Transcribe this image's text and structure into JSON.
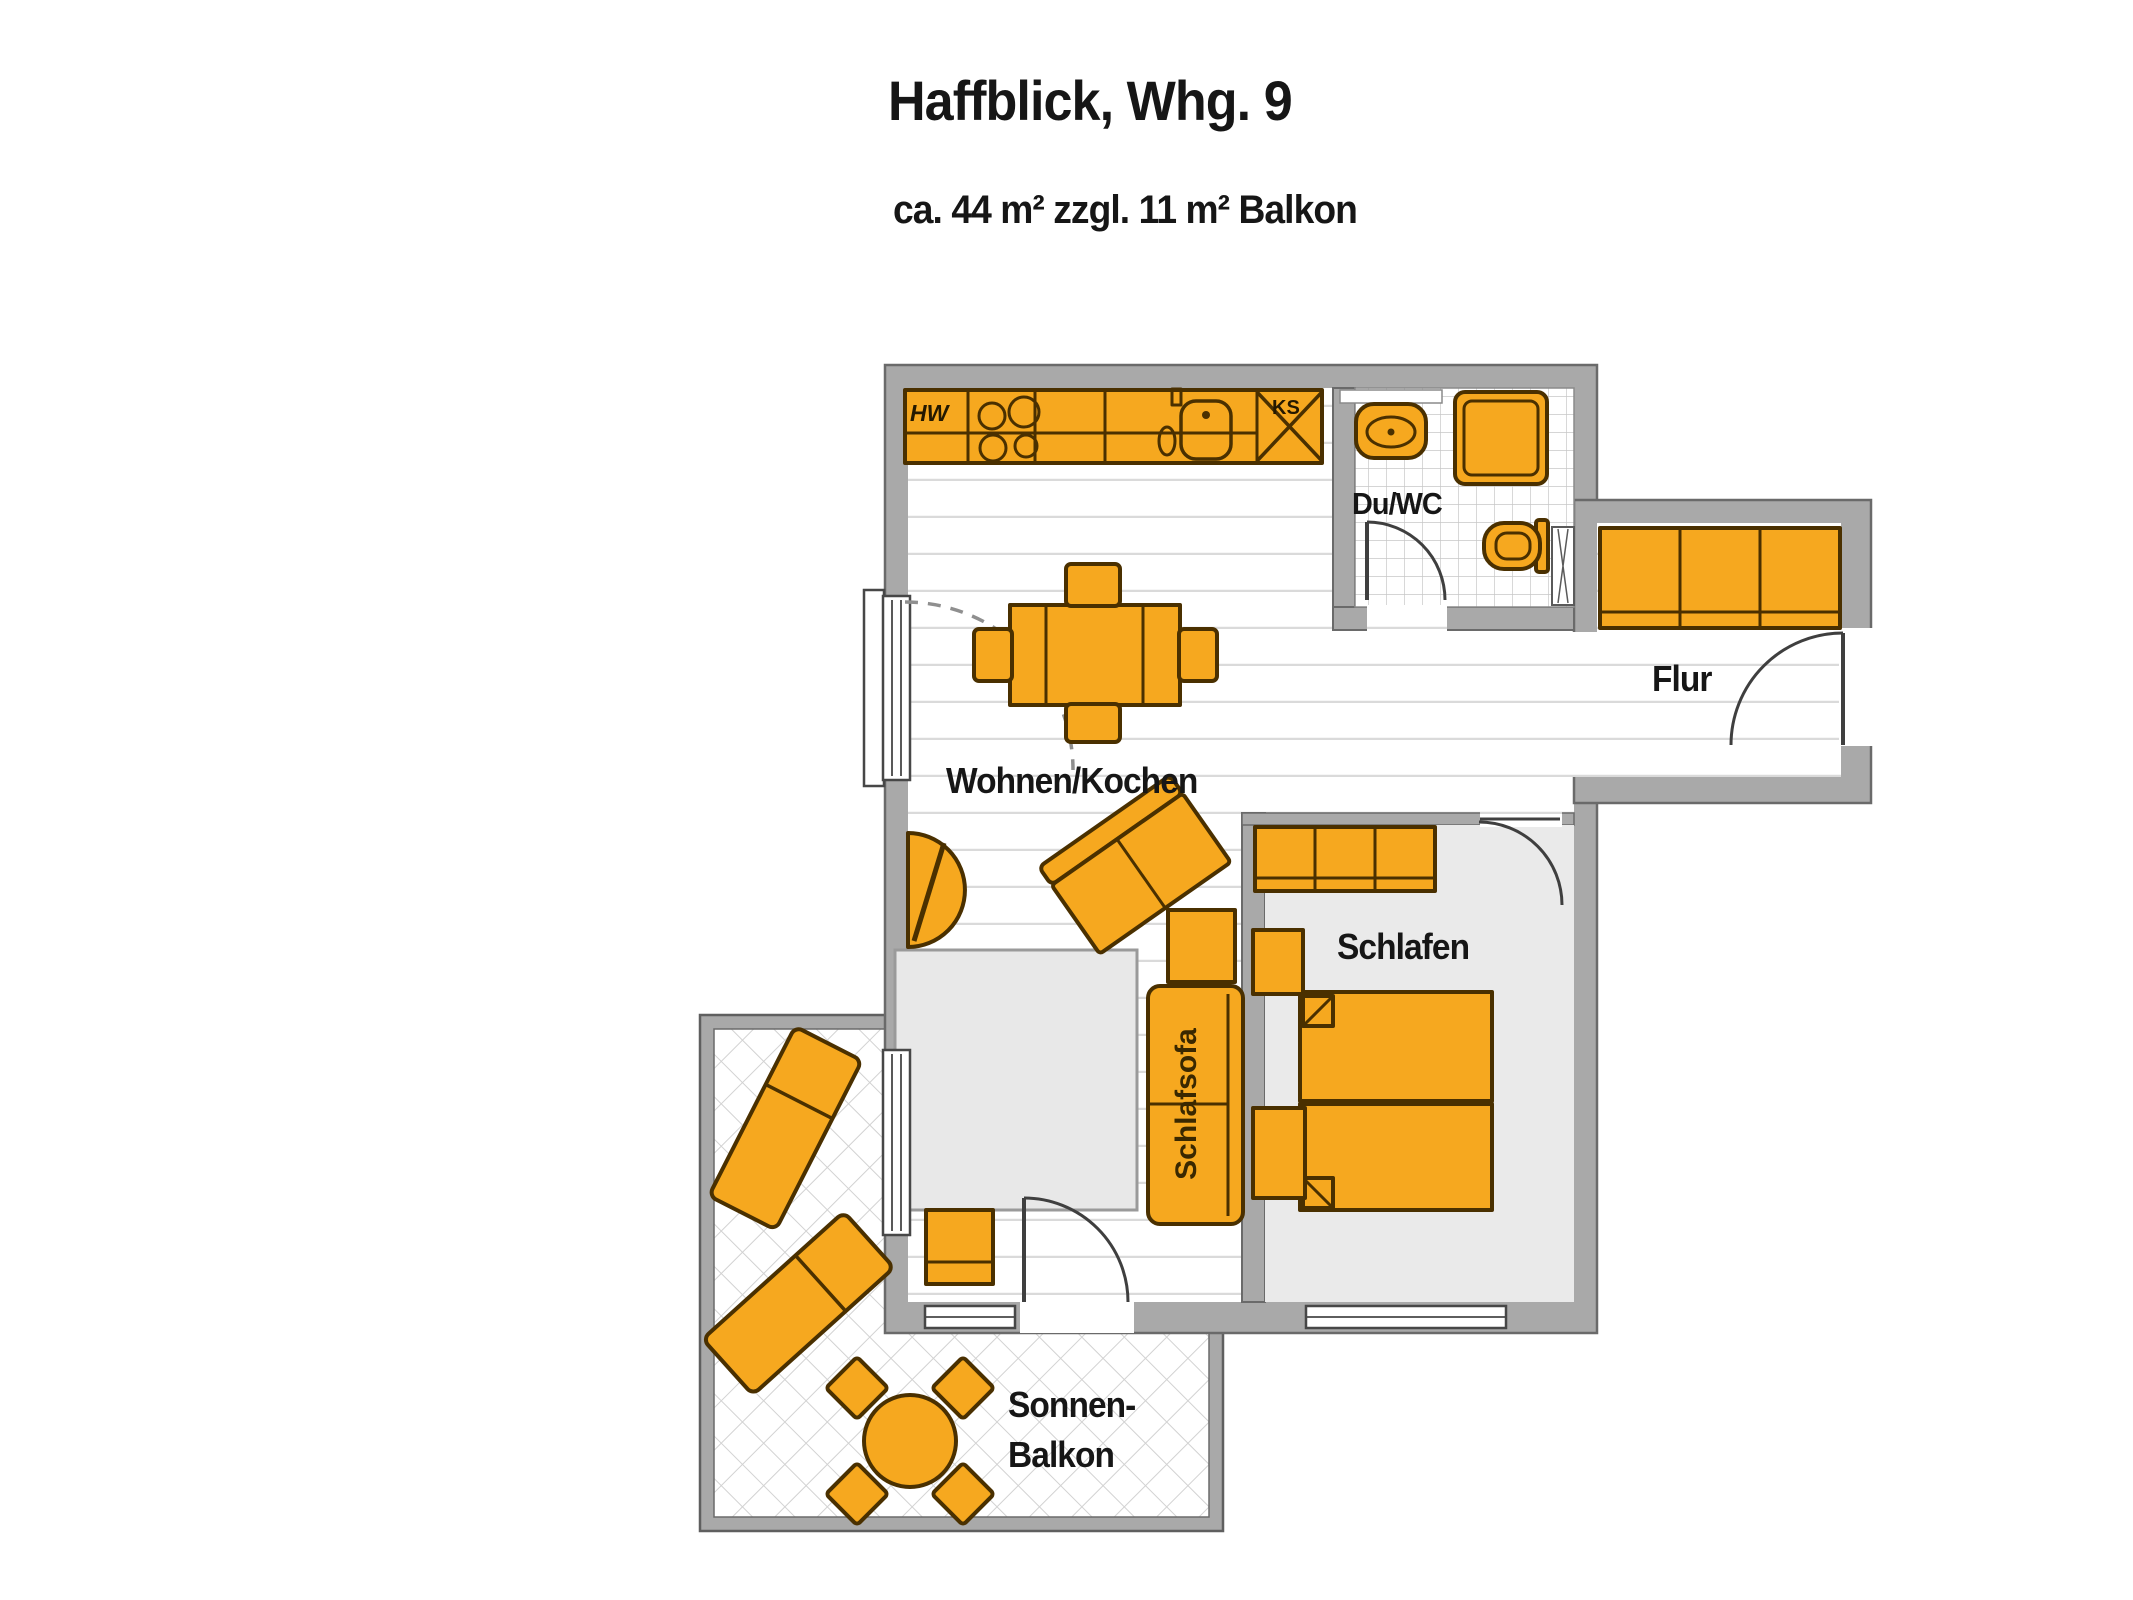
{
  "header": {
    "title": "Haffblick, Whg. 9",
    "subtitle": "ca. 44 m² zzgl. 11 m² Balkon"
  },
  "rooms": {
    "living": {
      "label": "Wohnen/Kochen"
    },
    "bathroom": {
      "label": "Du/WC"
    },
    "hallway": {
      "label": "Flur"
    },
    "bedroom": {
      "label": "Schlafen"
    },
    "balcony": {
      "label_line1": "Sonnen-",
      "label_line2": "Balkon"
    }
  },
  "furniture_labels": {
    "sleeper_sofa": "Schlafsofa",
    "washer": "HW",
    "fridge": "KS"
  },
  "colors": {
    "furniture_fill": "#F6A81F",
    "furniture_border": "#4A3000",
    "wall_fill": "#A9A9A9",
    "wall_border": "#6A6A6A",
    "bedroom_floor": "#EAEAEA",
    "rug": "#E8E8E8",
    "text": "#161616"
  }
}
